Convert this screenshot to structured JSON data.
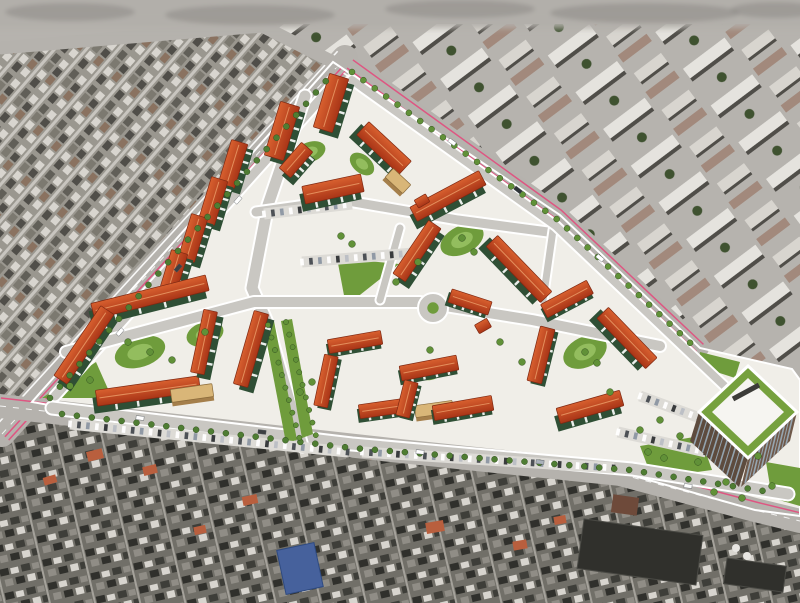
{
  "meta": {
    "description": "Aerial 3D architectural rendering of a new residential district (green-facade apartment blocks with red roofs around courtyards, white streets, lawns, an office tower) overlaid on a gray satellite photo of the surrounding city",
    "canvas": {
      "width": 800,
      "height": 603
    }
  },
  "palette": {
    "sat-base": "#9a978f",
    "sat-street": "#c8c5bf",
    "sat-dark": "#504e49",
    "sat-dark2": "#615f58",
    "sat-mid": "#7c7970",
    "sat-light": "#d8d5cf",
    "sat-roofr": "#8a7260",
    "sat-base2": "#b6b3ae",
    "sat-light2": "#e5e3de",
    "sat-roof2": "#a2897c",
    "sat-blur": "#b2afaa",
    "low-base": "#716f68",
    "low-dark": "#30302c",
    "low-dark2": "#3e3e39",
    "low-mid": "#908d86",
    "low-street": "#a5a29b",
    "tree-dark": "#3f5230",
    "tree": "#4f7d33",
    "tree2": "#619138",
    "site": "#f0eee8",
    "road": "#c9c7c2",
    "road-outer": "#b5b2ad",
    "pink": "#e0517f",
    "roof1": "#d8602f",
    "roof2": "#a93517",
    "roof-stroke": "#7e2812",
    "ridge": "#eda06b",
    "facade": "#2f4f35",
    "facade2": "#3d6343",
    "lawn": "#6f9c3c",
    "lawn-light": "#93bd5e",
    "tan": "#d9b678",
    "tan-dark": "#a57f4b",
    "tower-face1": "#5d4b3e",
    "tower-face2": "#6f594a",
    "tower-glass": "#9db3c2",
    "tower-roof": "#f6f5f1",
    "tower-green": "#76a13e",
    "blue-roof": "#46619c",
    "dark-block": "#30302c",
    "white": "#ffffff"
  },
  "regions": {
    "old_town": {
      "pts": [
        [
          0,
          46
        ],
        [
          262,
          24
        ],
        [
          333,
          62
        ],
        [
          36,
          404
        ],
        [
          0,
          416
        ]
      ],
      "pattern": "pat-old"
    },
    "upper_city": {
      "pts": [
        [
          262,
          24
        ],
        [
          800,
          24
        ],
        [
          800,
          376
        ],
        [
          792,
          369
        ],
        [
          700,
          348
        ],
        [
          560,
          215
        ],
        [
          350,
          66
        ]
      ],
      "pattern": "pat-upper"
    },
    "lower_city": {
      "pts": [
        [
          0,
          416
        ],
        [
          36,
          404
        ],
        [
          150,
          423
        ],
        [
          400,
          450
        ],
        [
          620,
          473
        ],
        [
          755,
          510
        ],
        [
          800,
          521
        ],
        [
          800,
          603
        ],
        [
          0,
          603
        ]
      ],
      "pattern": "pat-lower"
    }
  },
  "top_blur": {
    "height": 30,
    "blobs": [
      [
        70,
        12,
        65,
        9
      ],
      [
        250,
        15,
        85,
        10
      ],
      [
        460,
        9,
        75,
        9
      ],
      [
        645,
        13,
        95,
        10
      ],
      [
        775,
        10,
        45,
        8
      ]
    ]
  },
  "site": {
    "outline": [
      [
        333,
        62
      ],
      [
        560,
        215
      ],
      [
        700,
        348
      ],
      [
        792,
        369
      ],
      [
        800,
        380
      ],
      [
        800,
        516
      ],
      [
        755,
        510
      ],
      [
        620,
        472
      ],
      [
        400,
        449
      ],
      [
        150,
        423
      ],
      [
        32,
        402
      ]
    ]
  },
  "boundary_roads": [
    {
      "name": "west-avenue",
      "pts": [
        [
          2,
          434
        ],
        [
          345,
          58
        ]
      ],
      "w": 26,
      "dash": true,
      "pink": [
        4,
        9
      ],
      "edge": [
        -10
      ]
    },
    {
      "name": "northeast-road",
      "pts": [
        [
          350,
          64
        ],
        [
          558,
          214
        ],
        [
          700,
          348
        ]
      ],
      "w": 18,
      "dash": false,
      "pink": [
        -5,
        5
      ],
      "edge": [
        11
      ]
    },
    {
      "name": "south-highway",
      "pts": [
        [
          0,
          406
        ],
        [
          150,
          423
        ],
        [
          400,
          451
        ],
        [
          620,
          474
        ],
        [
          755,
          510
        ],
        [
          800,
          521
        ]
      ],
      "w": 24,
      "dash": true,
      "pink": [
        -8
      ],
      "edge": []
    },
    {
      "name": "north-street",
      "pts": [
        [
          0,
          48
        ],
        [
          262,
          26
        ],
        [
          333,
          62
        ]
      ],
      "w": 13,
      "dash": false,
      "pink": [],
      "edge": []
    }
  ],
  "internal_roads": [
    {
      "pts": [
        [
          55,
          396
        ],
        [
          333,
          85
        ]
      ],
      "w": 9
    },
    {
      "pts": [
        [
          52,
          408
        ],
        [
          352,
          444
        ],
        [
          632,
          469
        ],
        [
          788,
          494
        ]
      ],
      "w": 11
    },
    {
      "pts": [
        [
          305,
          96
        ],
        [
          268,
          205
        ],
        [
          252,
          288
        ],
        [
          266,
          320
        ],
        [
          302,
          446
        ]
      ],
      "w": 11
    },
    {
      "pts": [
        [
          66,
          352
        ],
        [
          254,
          302
        ],
        [
          420,
          302
        ],
        [
          532,
          320
        ],
        [
          660,
          346
        ]
      ],
      "w": 10
    },
    {
      "pts": [
        [
          256,
          212
        ],
        [
          342,
          200
        ],
        [
          458,
          220
        ],
        [
          548,
          232
        ]
      ],
      "w": 9
    },
    {
      "pts": [
        [
          380,
          300
        ],
        [
          400,
          228
        ]
      ],
      "w": 7
    },
    {
      "pts": [
        [
          553,
          230
        ],
        [
          543,
          300
        ]
      ],
      "w": 7
    },
    {
      "pts": [
        [
          352,
          80
        ],
        [
          556,
          226
        ],
        [
          735,
          396
        ]
      ],
      "w": 8
    }
  ],
  "roundabout": {
    "cx": 433,
    "cy": 308,
    "r": 15
  },
  "lawns": {
    "polys": [
      [
        [
          337,
          258
        ],
        [
          399,
          264
        ],
        [
          346,
          306
        ]
      ],
      [
        [
          42,
          398
        ],
        [
          96,
          362
        ],
        [
          112,
          398
        ]
      ],
      [
        [
          640,
          446
        ],
        [
          700,
          436
        ],
        [
          712,
          470
        ],
        [
          652,
          478
        ]
      ],
      [
        [
          766,
          462
        ],
        [
          800,
          468
        ],
        [
          800,
          506
        ],
        [
          772,
          498
        ]
      ],
      [
        [
          700,
          352
        ],
        [
          740,
          362
        ],
        [
          735,
          378
        ],
        [
          698,
          366
        ]
      ]
    ],
    "courts": [
      [
        140,
        352,
        26,
        15,
        -18
      ],
      [
        205,
        334,
        19,
        12,
        -18
      ],
      [
        462,
        240,
        23,
        14,
        -26
      ],
      [
        585,
        352,
        23,
        15,
        -26
      ],
      [
        310,
        152,
        16,
        10,
        -20
      ],
      [
        362,
        164,
        14,
        9,
        40
      ],
      [
        430,
        372,
        13,
        8,
        -12
      ]
    ]
  },
  "boulevard": {
    "strips": [
      [
        [
          263,
          323
        ],
        [
          274,
          321
        ],
        [
          297,
          440
        ],
        [
          286,
          443
        ]
      ],
      [
        [
          281,
          321
        ],
        [
          292,
          319
        ],
        [
          313,
          434
        ],
        [
          302,
          438
        ]
      ]
    ]
  },
  "blocks": [
    [
      282,
      131,
      56,
      20,
      -73,
      "t"
    ],
    [
      331,
      103,
      56,
      20,
      -73,
      "t"
    ],
    [
      384,
      148,
      58,
      18,
      43,
      "t"
    ],
    [
      333,
      189,
      60,
      18,
      -12,
      "t"
    ],
    [
      296,
      160,
      34,
      15,
      -49,
      "t"
    ],
    [
      398,
      181,
      24,
      12,
      43,
      "n"
    ],
    [
      233,
      164,
      46,
      17,
      -73,
      "t"
    ],
    [
      213,
      201,
      46,
      17,
      -73,
      "t"
    ],
    [
      193,
      238,
      46,
      17,
      -73,
      "t"
    ],
    [
      173,
      274,
      46,
      17,
      -73,
      "t"
    ],
    [
      150,
      297,
      118,
      16,
      -14,
      "t"
    ],
    [
      84,
      345,
      84,
      16,
      -56,
      "t"
    ],
    [
      148,
      391,
      104,
      16,
      -8,
      "t"
    ],
    [
      204,
      342,
      64,
      14,
      -78,
      "t"
    ],
    [
      251,
      349,
      76,
      15,
      -74,
      "t"
    ],
    [
      192,
      393,
      42,
      13,
      -8,
      "n"
    ],
    [
      355,
      342,
      54,
      14,
      -10,
      "l"
    ],
    [
      326,
      381,
      52,
      14,
      -78,
      "l"
    ],
    [
      386,
      408,
      54,
      14,
      -8,
      "l"
    ],
    [
      434,
      409,
      38,
      12,
      -8,
      "n"
    ],
    [
      448,
      196,
      78,
      16,
      -28,
      "t"
    ],
    [
      519,
      269,
      78,
      16,
      46,
      "t"
    ],
    [
      417,
      251,
      64,
      15,
      -56,
      "t"
    ],
    [
      470,
      302,
      42,
      14,
      18,
      "l"
    ],
    [
      567,
      299,
      52,
      15,
      -28,
      "l"
    ],
    [
      627,
      338,
      70,
      16,
      46,
      "t"
    ],
    [
      590,
      407,
      66,
      16,
      -16,
      "t"
    ],
    [
      541,
      355,
      56,
      15,
      -76,
      "l"
    ],
    [
      429,
      368,
      58,
      15,
      -11,
      "l"
    ],
    [
      463,
      408,
      60,
      15,
      -10,
      "l"
    ],
    [
      407,
      399,
      36,
      14,
      -76,
      "l"
    ],
    [
      483,
      326,
      14,
      10,
      -30,
      "k"
    ],
    [
      422,
      201,
      13,
      9,
      -30,
      "k"
    ]
  ],
  "tower": {
    "roof_outer": [
      [
        748,
        366
      ],
      [
        797,
        412
      ],
      [
        748,
        458
      ],
      [
        699,
        412
      ]
    ],
    "roof_inner": [
      [
        748,
        378
      ],
      [
        784,
        412
      ],
      [
        748,
        446
      ],
      [
        712,
        412
      ]
    ],
    "slot": [
      [
        733,
        399
      ],
      [
        759,
        385
      ]
    ],
    "faces": [
      {
        "top": [
          [
            699,
            412
          ],
          [
            748,
            458
          ]
        ],
        "bot": [
          [
            690,
            441
          ],
          [
            739,
            487
          ]
        ],
        "fill": "tower-face1"
      },
      {
        "top": [
          [
            748,
            458
          ],
          [
            797,
            412
          ]
        ],
        "bot": [
          [
            741,
            487
          ],
          [
            790,
            441
          ]
        ],
        "fill": "tower-face2"
      }
    ],
    "stripes": 12
  },
  "parking": [
    {
      "a": [
        70,
        424
      ],
      "b": [
        348,
        452
      ]
    },
    {
      "a": [
        362,
        452
      ],
      "b": [
        614,
        468
      ]
    },
    {
      "a": [
        264,
        214
      ],
      "b": [
        352,
        204
      ]
    },
    {
      "a": [
        302,
        262
      ],
      "b": [
        414,
        253
      ]
    },
    {
      "a": [
        618,
        432
      ],
      "b": [
        706,
        452
      ]
    },
    {
      "a": [
        640,
        396
      ],
      "b": [
        700,
        418
      ]
    }
  ],
  "trees": {
    "rows": [
      {
        "pts": [
          [
            50,
            398
          ],
          [
            332,
            74
          ]
        ],
        "step": 15,
        "r": 3,
        "c": "tree"
      },
      {
        "pts": [
          [
            62,
            414
          ],
          [
            352,
            448
          ],
          [
            630,
            470
          ],
          [
            770,
            492
          ]
        ],
        "step": 15,
        "r": 3,
        "c": "tree"
      },
      {
        "pts": [
          [
            352,
            72
          ],
          [
            558,
            220
          ],
          [
            700,
            352
          ]
        ],
        "step": 14,
        "r": 3,
        "c": "tree2"
      },
      {
        "pts": [
          [
            268,
            325
          ],
          [
            300,
            440
          ]
        ],
        "step": 13,
        "r": 2.6,
        "c": "tree2"
      },
      {
        "pts": [
          [
            286,
            322
          ],
          [
            316,
            436
          ]
        ],
        "step": 13,
        "r": 2.6,
        "c": "tree2"
      }
    ],
    "singles": [
      [
        150,
        352
      ],
      [
        128,
        342
      ],
      [
        172,
        360
      ],
      [
        205,
        332
      ],
      [
        462,
        238
      ],
      [
        474,
        252
      ],
      [
        585,
        352
      ],
      [
        597,
        363
      ],
      [
        352,
        244
      ],
      [
        341,
        236
      ],
      [
        648,
        452
      ],
      [
        664,
        458
      ],
      [
        698,
        462
      ],
      [
        726,
        482
      ],
      [
        758,
        456
      ],
      [
        640,
        430
      ],
      [
        90,
        380
      ],
      [
        70,
        386
      ],
      [
        300,
        392
      ],
      [
        312,
        382
      ],
      [
        430,
        350
      ],
      [
        500,
        342
      ],
      [
        522,
        362
      ],
      [
        610,
        392
      ],
      [
        418,
        262
      ],
      [
        396,
        282
      ],
      [
        660,
        420
      ],
      [
        680,
        436
      ],
      [
        714,
        492
      ],
      [
        742,
        498
      ],
      [
        772,
        486
      ]
    ]
  },
  "vehicles": [
    [
      140,
      418,
      7,
      "#ffffff"
    ],
    [
      262,
      432,
      7,
      "#3c4043"
    ],
    [
      420,
      452,
      6,
      "#ffffff"
    ],
    [
      540,
      462,
      6,
      "#aab2ba"
    ],
    [
      688,
      486,
      7,
      "#ffffff"
    ],
    [
      120,
      332,
      -49,
      "#ffffff"
    ],
    [
      178,
      268,
      -49,
      "#3c4043"
    ],
    [
      238,
      200,
      -49,
      "#ffffff"
    ],
    [
      452,
      142,
      36,
      "#ffffff"
    ],
    [
      518,
      190,
      38,
      "#2f3438"
    ],
    [
      600,
      258,
      40,
      "#ffffff"
    ]
  ],
  "sat_extras": {
    "blue_building": {
      "x": 281,
      "y": 546,
      "w": 38,
      "h": 45,
      "rot": -12
    },
    "dark_blocks": [
      [
        640,
        552,
        120,
        50,
        8
      ],
      [
        755,
        575,
        60,
        26,
        8
      ]
    ],
    "brown_patch": [
      625,
      505,
      26,
      18,
      8
    ],
    "tanks": [
      [
        736,
        548,
        4
      ],
      [
        747,
        556,
        4
      ]
    ],
    "orange_roofs": [
      [
        95,
        455,
        16,
        10,
        -14
      ],
      [
        150,
        470,
        14,
        9,
        -14
      ],
      [
        250,
        500,
        15,
        9,
        -12
      ],
      [
        435,
        527,
        18,
        11,
        -10
      ],
      [
        375,
        455,
        12,
        8,
        -12
      ],
      [
        520,
        545,
        14,
        9,
        -10
      ],
      [
        50,
        480,
        13,
        8,
        -16
      ],
      [
        200,
        530,
        12,
        8,
        -12
      ],
      [
        300,
        572,
        13,
        8,
        -12
      ],
      [
        560,
        520,
        12,
        8,
        -10
      ]
    ]
  }
}
